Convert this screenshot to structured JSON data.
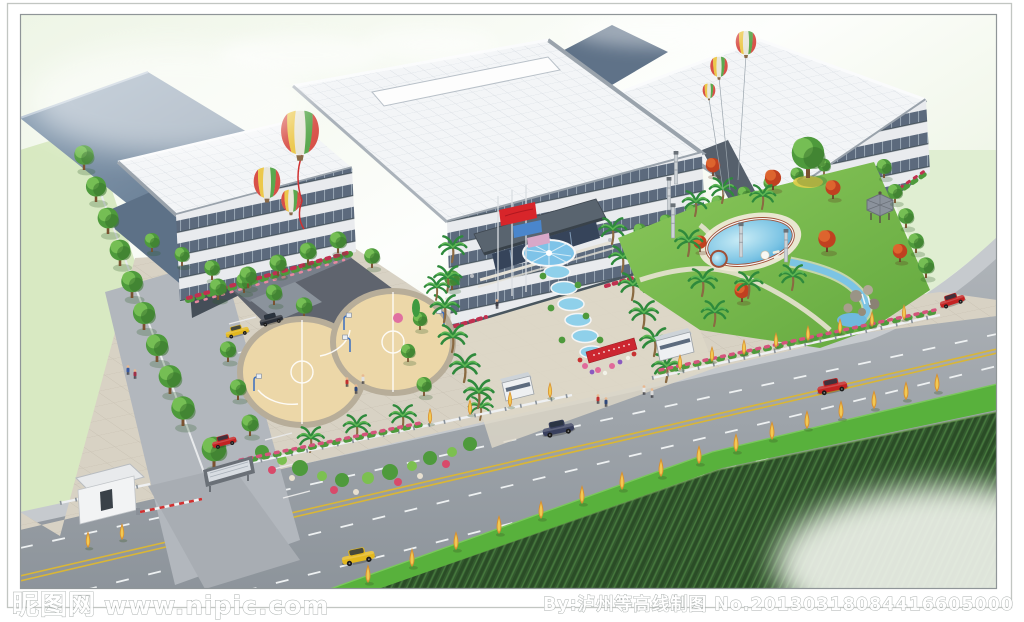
{
  "scene": {
    "description": "Aerial bird's-eye architectural rendering of a factory campus: large office building with white tiled roof, slate-roofed warehouses behind, landscaped grounds with swimming pool, gazebo, rockery, two circular basketball courts, central flag plaza with cascade water feature, gate with red banner, and a tree-lined highway with green median in front of a rough grass field",
    "palette": {
      "sky": "#f4f9ef",
      "field_light": "#d8e8c4",
      "field_dark": "#33592e",
      "road": "#9aa1a8",
      "roof_white": "#f3f5f7",
      "roof_slate": "#6b7f95",
      "facade_window": "#5c6a7d",
      "lawn": "#76bd4c",
      "pool_blue": "#4aa6d5",
      "court_tan": "#ecd7a8",
      "maple_red": "#c84a24",
      "tree_green": "#4e9a3c",
      "poplar_orange": "#e0a23c",
      "flower_pink": "#e06a9a",
      "banner_red": "#cc2630",
      "flag_red": "#d8252a",
      "flag_blue": "#4a86cc",
      "car_yellow": "#e3b81e",
      "car_red": "#c32222",
      "car_navy": "#39405e"
    },
    "features": [
      "main office building",
      "left factory warehouses",
      "right wing building",
      "striped hot-air balloons",
      "entrance plaza with flag poles",
      "cascade water feature",
      "gate with red banner",
      "kidney swimming pool",
      "hexagonal gazebo",
      "rockery and stream",
      "two circular basketball courts",
      "west parking lot",
      "tree-lined highway with green median",
      "rough grass field"
    ]
  },
  "watermark": {
    "site_label": "昵图网",
    "site_url": "www.nipic.com",
    "credit": "By:泸州等高线制图",
    "serial": "No.20130318084416605000"
  }
}
